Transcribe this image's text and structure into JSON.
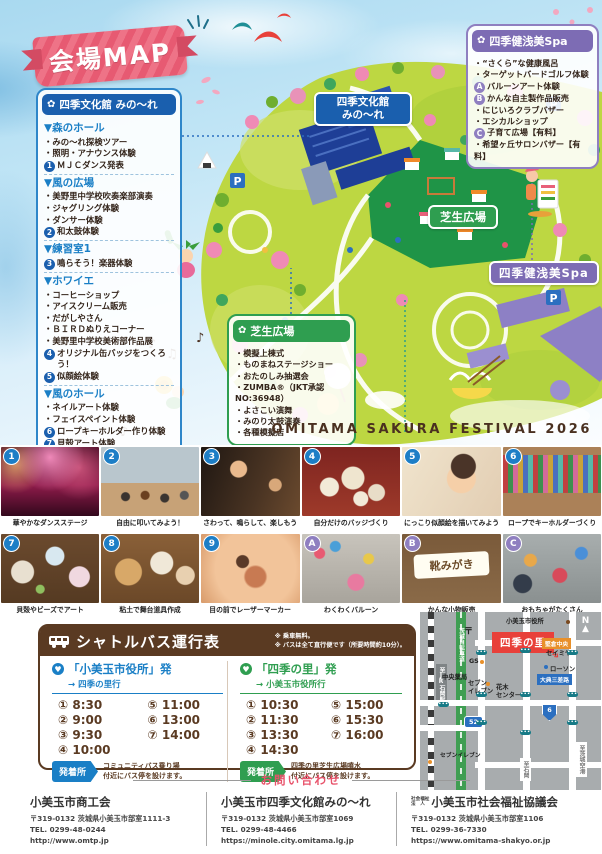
{
  "banner": {
    "title": "会場MAP"
  },
  "festival_title": "OMITAMA SAKURA FESTIVAL 2026",
  "map": {
    "minole_label_1": "四季文化館",
    "minole_label_2": "みの〜れ",
    "lawn_label": "芝生広場",
    "spa_label": "四季健浅美Spa",
    "parking": "P"
  },
  "minole": {
    "title": "四季文化館 みの〜れ",
    "sections": [
      {
        "heading": "▼森のホール",
        "items": [
          {
            "text": "・みの〜れ探検ツアー"
          },
          {
            "text": "・照明・アナウンス体験"
          },
          {
            "badge": "1",
            "text": "ＭＪＣダンス発表"
          }
        ]
      },
      {
        "heading": "▼風の広場",
        "items": [
          {
            "text": "・美野里中学校吹奏楽部演奏"
          },
          {
            "text": "・ジャグリング体験"
          },
          {
            "text": "・ダンサー体験"
          },
          {
            "badge": "2",
            "text": "和太鼓体験"
          }
        ]
      },
      {
        "heading": "▼練習室1",
        "items": [
          {
            "badge": "3",
            "text": "鳴らそう！楽器体験"
          }
        ]
      },
      {
        "heading": "▼ホワイエ",
        "items": [
          {
            "text": "・コーヒーショップ"
          },
          {
            "text": "・アイスクリーム販売"
          },
          {
            "text": "・だがしやさん"
          },
          {
            "text": "・ＢＩＲＤぬりえコーナー"
          },
          {
            "text": "・美野里中学校美術部作品展"
          },
          {
            "badge": "4",
            "text": "オリジナル缶バッジをつくろう！"
          },
          {
            "badge": "5",
            "text": "似顔絵体験"
          }
        ]
      },
      {
        "heading": "▼風のホール",
        "items": [
          {
            "text": "・ネイルアート体験"
          },
          {
            "text": "・フェイスペイント体験"
          },
          {
            "badge": "6",
            "text": "ロープキーホルダー作り体験"
          },
          {
            "badge": "7",
            "text": "貝殻アート体験"
          },
          {
            "badge": "8",
            "text": "小道具職人体験"
          },
          {
            "badge": "9",
            "text": "デジタルアート体験"
          },
          {
            "text": "・カメラマン体験"
          },
          {
            "text": "・フラワーアレンジメント体験"
          }
        ]
      }
    ]
  },
  "spa": {
    "title": "四季健浅美Spa",
    "items": [
      {
        "text": "・“さくら”な健康風呂"
      },
      {
        "text": "・ターゲットバードゴルフ体験"
      },
      {
        "badge": "A",
        "text": "バルーンアート体験"
      },
      {
        "badge": "B",
        "text": "かんな自主製作品販売"
      },
      {
        "text": "・にじいろクラブバザー"
      },
      {
        "text": "・エシカルショップ"
      },
      {
        "badge": "C",
        "text": "子育て広場【有料】"
      },
      {
        "text": "・希望ヶ丘サロンバザー【有料】"
      }
    ]
  },
  "lawn": {
    "title": "芝生広場",
    "items": [
      {
        "text": "・模擬上棟式"
      },
      {
        "text": "・ものまねステージショー"
      },
      {
        "text": "・おたのしみ抽選会"
      },
      {
        "text": "・ZUMBA®（JKT承認NO:36948）"
      },
      {
        "text": "・よさこい演舞"
      },
      {
        "text": "・みのり太鼓演奏"
      },
      {
        "text": "・各種模擬店"
      }
    ]
  },
  "photos": [
    {
      "badge": "1",
      "tone": "blue",
      "art": "p1",
      "caption": "華やかなダンスステージ"
    },
    {
      "badge": "2",
      "tone": "blue",
      "art": "p2",
      "caption": "自由に叩いてみよう！"
    },
    {
      "badge": "3",
      "tone": "blue",
      "art": "p3",
      "caption": "さわって、鳴らして、楽しもう"
    },
    {
      "badge": "4",
      "tone": "blue",
      "art": "p4",
      "caption": "自分だけのバッジづくり"
    },
    {
      "badge": "5",
      "tone": "blue",
      "art": "p5",
      "caption": "にっこり似顔絵を描いてみよう"
    },
    {
      "badge": "6",
      "tone": "blue",
      "art": "p6",
      "caption": "ロープでキーホルダーづくり"
    },
    {
      "badge": "7",
      "tone": "blue",
      "art": "p7",
      "caption": "貝殻やビーズでアート"
    },
    {
      "badge": "8",
      "tone": "blue",
      "art": "p8",
      "caption": "粘土で舞台道具作成"
    },
    {
      "badge": "9",
      "tone": "blue",
      "art": "p9",
      "caption": "目の前でレーザーマーカー"
    },
    {
      "badge": "A",
      "tone": "purple",
      "art": "p10",
      "caption": "わくわくバルーン"
    },
    {
      "badge": "B",
      "tone": "purple",
      "art": "p11",
      "caption": "かんな小物販売",
      "overlay": "靴みがき"
    },
    {
      "badge": "C",
      "tone": "purple",
      "art": "p12",
      "caption": "おもちゃがたくさん"
    }
  ],
  "shuttle": {
    "title": "シャトルバス運行表",
    "notes": [
      "※ 乗車無料。",
      "※ バスは全て直行便です（所要時間約10分）。"
    ],
    "left": {
      "from": "「小美玉市役所」発",
      "to": "→ 四季の里行",
      "times": [
        "① 8:30",
        "② 9:00",
        "③ 9:30",
        "④ 10:00",
        "⑤ 11:00",
        "⑥ 13:00",
        "⑦ 14:00"
      ],
      "stop_label": "発着所",
      "stop_desc1": "コミュニティバス乗り場",
      "stop_desc2": "付近にバス停を設けます。"
    },
    "right": {
      "from": "「四季の里」発",
      "to": "→ 小美玉市役所行",
      "times": [
        "① 10:30",
        "② 11:30",
        "③ 13:30",
        "④ 14:30",
        "⑤ 15:00",
        "⑥ 15:30",
        "⑦ 16:00"
      ],
      "stop_label": "発着所",
      "stop_desc1": "四季の里芝生広場噴水",
      "stop_desc2": "付近にバス停を設けます。"
    }
  },
  "citymap": {
    "city_hall": "小美玉市役所",
    "shiki_no_sato": "四季の里",
    "katakura": "堅倉中央",
    "seimiya": "セイミヤ",
    "lawson": "ローソン",
    "gs": "GS",
    "pharmacy": "中央薬局",
    "seven1": "セブン\nイレブン",
    "seven2": "セブンイレブン",
    "hanaki": "花木\nセンター",
    "junction": "大典三差路",
    "rail_label": "至JR石岡駅",
    "green_label": "茨城自転車道",
    "to_ishioka": "至石岡",
    "to_airport": "至茨城空港",
    "route52": "52",
    "route6": "6",
    "north": "N",
    "post": "〒"
  },
  "contact": {
    "header": "お問い合わせ",
    "orgs": [
      {
        "name": "小美玉市商工会",
        "address": "〒319-0132 茨城県小美玉市部室1111-3",
        "tel": "TEL. 0299-48-0244",
        "url": "http://www.omtp.jp"
      },
      {
        "name": "小美玉市四季文化館みの〜れ",
        "address": "〒319-0132 茨城県小美玉市部室1069",
        "tel": "TEL. 0299-48-4466",
        "url": "https://minole.city.omitama.lg.jp"
      },
      {
        "prefix1": "社会福祉",
        "prefix2": "法　人",
        "name": "小美玉市社会福祉協議会",
        "address": "〒319-0132 茨城県小美玉市部室1106",
        "tel": "TEL. 0299-36-7330",
        "url": "https://www.omitama-shakyo.or.jp"
      }
    ]
  }
}
